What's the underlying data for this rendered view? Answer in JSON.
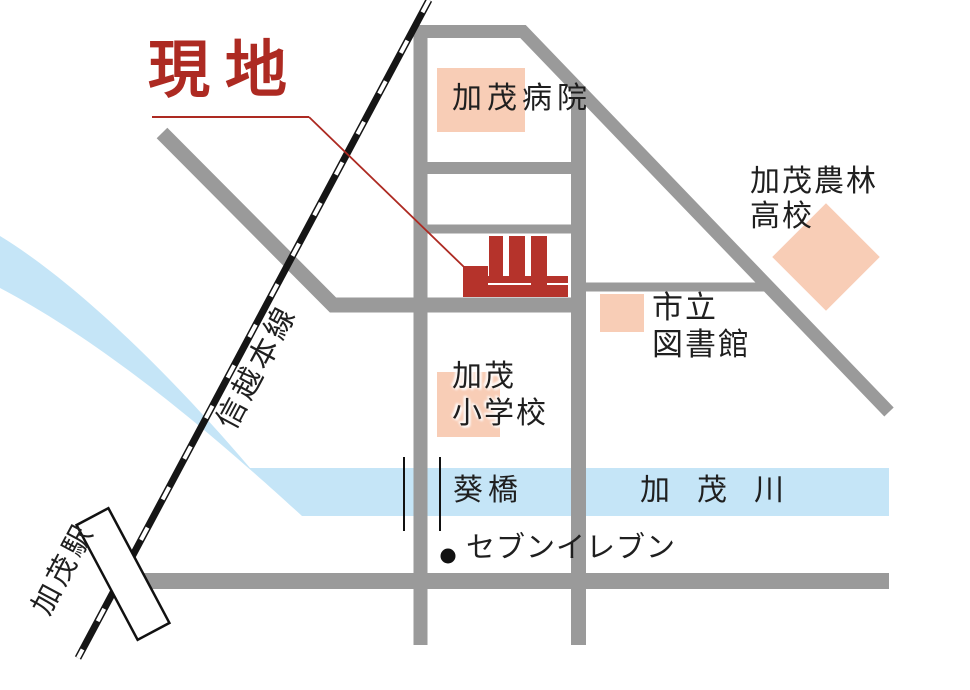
{
  "map": {
    "site_label": "現地",
    "labels": {
      "hospital": "加茂病院",
      "highschool_line1": "加茂農林",
      "highschool_line2": "高校",
      "library_line1": "市立",
      "library_line2": "図書館",
      "elementary_line1": "加茂",
      "elementary_line2": "小学校",
      "bridge": "葵橋",
      "river": "加茂川",
      "convenience_store": "セブンイレブン",
      "station": "加茂駅",
      "railway": "信越本線"
    },
    "colors": {
      "red": "#ad2a22",
      "building_red": "#b5332b",
      "pink": "#f8cdb6",
      "road": "#9a9a9a",
      "river": "#c5e5f7",
      "text": "#1f1f1f"
    }
  }
}
